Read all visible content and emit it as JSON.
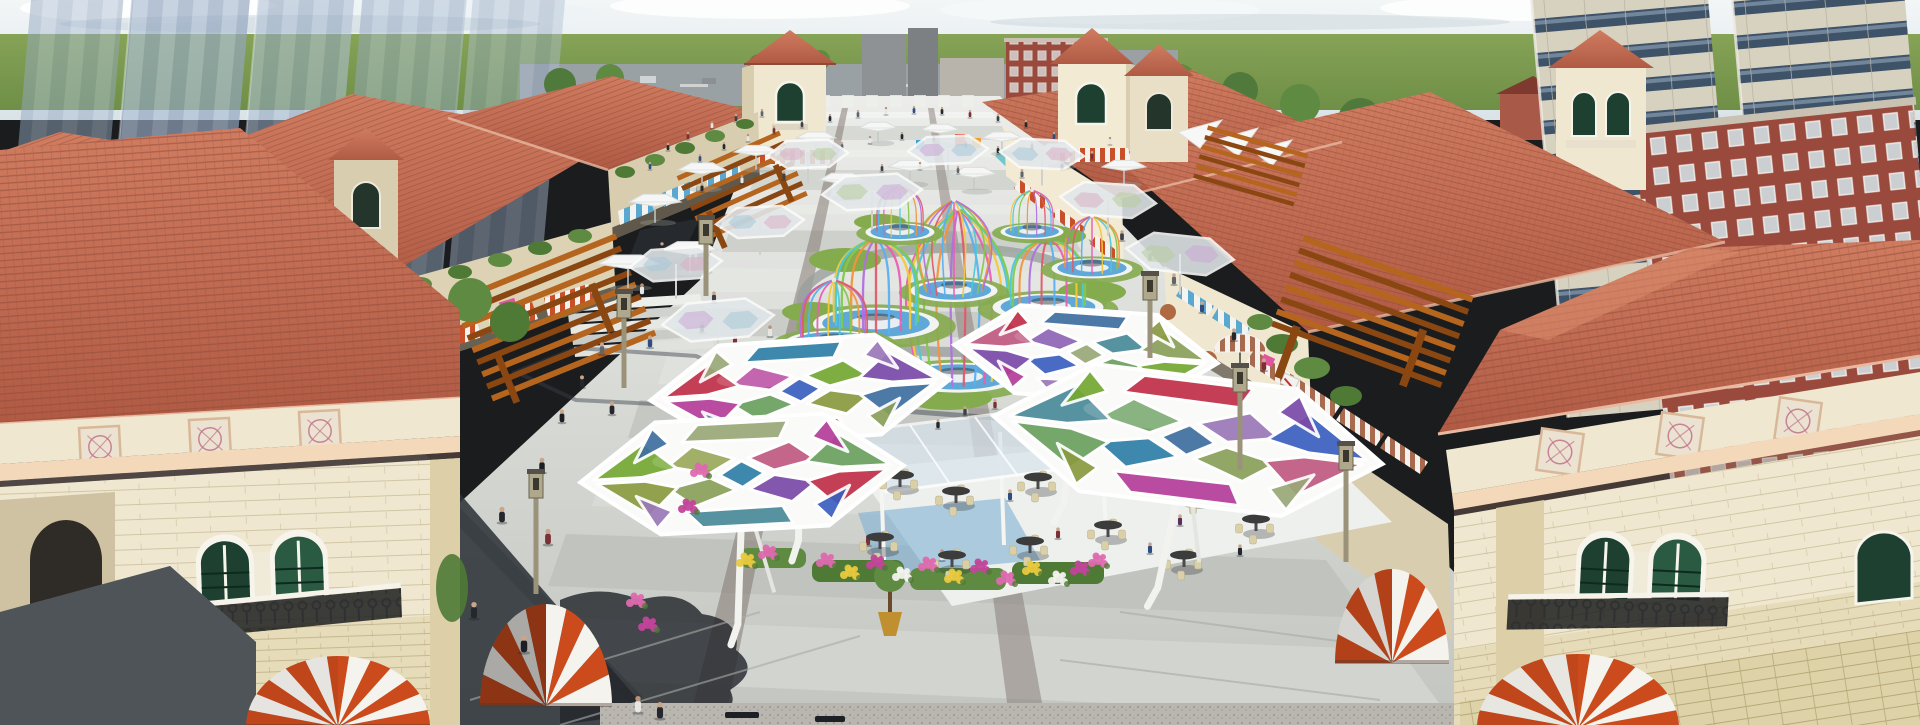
{
  "palette": {
    "sky_top": "#f3f6f7",
    "sky_low": "#d9e3e8",
    "cloud": "#ffffff",
    "cloud_shade": "#c5d2da",
    "field": "#83a153",
    "field_dark": "#5f8140",
    "road": "#9aa1a5",
    "ghost_a": "#aebfd4",
    "ghost_b": "#93a6bf",
    "tower_wall": "#d7d1c0",
    "tower_band": "#3e5268",
    "tower_glass": "#7e94a8",
    "brick": "#9a4a3c",
    "brick_light": "#b06a58",
    "roof": "#c2674f",
    "roof_dark": "#8e4a38",
    "roof_light": "#d98a6a",
    "ridge": "#e8b9a0",
    "wall": "#efe7d0",
    "wall_shade": "#d9cdb0",
    "wall_dark": "#c9bd9e",
    "sand": "#e6dcba",
    "sand_line": "#c6b88e",
    "cornice": "#f3d9ba",
    "medallion_bg": "#ece2d2",
    "medallion_ink": "#c2798c",
    "win_green": "#1d4030",
    "win_green2": "#2a5a42",
    "frame": "#f7f4ec",
    "iron": "#2e2f31",
    "awn_orange": "#cb4b1d",
    "awn_white": "#f5f3ee",
    "awn_blue": "#5aa7cf",
    "awn_brown": "#a76a4e",
    "sign_pink": "#e0559e",
    "pergola": "#b5651d",
    "pergola_dark": "#8a4712",
    "pave_base": "#d9dbd7",
    "pave_light": "#eceeea",
    "pave_mid": "#cfd2cd",
    "pave_dark": "#a8aba6",
    "strip_brown": "#7d6f6a",
    "shadow": "#2e3339",
    "shadow_soft": "#454b54",
    "grass": "#85ab4f",
    "bush": "#4f7a36",
    "tree": "#5e8a42",
    "water": "#5fa8d8",
    "water_deep": "#3d7fb5",
    "base_white": "#f2f4f4",
    "glass": "#d7e4ec",
    "deck": "#eef0ee",
    "carpet": "#7fb0d4",
    "table_dark": "#3c3c3c",
    "chair_tan": "#d9cfa8",
    "pot_gold": "#c08f2f",
    "pot_clay": "#b06a42",
    "granite": "#b9b6b0",
    "lamp": "#9a937a",
    "lamp_head": "#b0a88c",
    "flower_pink": "#dd6aae",
    "flower_magenta": "#c2449a",
    "flower_yellow": "#e9c93e",
    "flower_white": "#f2f2ee",
    "flower_red": "#c04545"
  },
  "people_colors": [
    "#24272c",
    "#3c4148",
    "#60666e",
    "#7a3034",
    "#2f4d7e",
    "#e6e6e4",
    "#8a6a52",
    "#1c1f23",
    "#9a9ea6",
    "#5a2f5a"
  ],
  "cage_colors": [
    "#e85fb0",
    "#f2c83c",
    "#4cc8d8",
    "#82c84e",
    "#f2923c",
    "#b070e0",
    "#e05a6a",
    "#58b0f0"
  ],
  "hex_panel_colors": [
    "#c03048",
    "#b43d9a",
    "#3b5fc0",
    "#74a832",
    "#8a9a40",
    "#2f7fa8",
    "#c05a80",
    "#7a4aa8",
    "#9aa878",
    "#4a8a9a",
    "#6aa060",
    "#3f6fa0",
    "#9a78b8",
    "#8aa05a"
  ],
  "ghost_tints": [
    "#c9a8d6",
    "#a8c8d8",
    "#d8b0c4",
    "#b8cc9e"
  ],
  "hex_panels": [
    {
      "p": [
        [
          -0.14,
          0
        ],
        [
          0,
          -0.24
        ],
        [
          0.14,
          0
        ],
        [
          0,
          0.24
        ]
      ],
      "ci": 2
    },
    {
      "p": [
        [
          0.04,
          -0.28
        ],
        [
          0.3,
          -0.54
        ],
        [
          0.46,
          -0.2
        ],
        [
          0.2,
          -0.04
        ]
      ],
      "ci": 3
    },
    {
      "p": [
        [
          0.2,
          0.04
        ],
        [
          0.46,
          0.2
        ],
        [
          0.3,
          0.54
        ],
        [
          0.04,
          0.28
        ]
      ],
      "ci": 4
    },
    {
      "p": [
        [
          -0.04,
          0.28
        ],
        [
          -0.3,
          0.54
        ],
        [
          -0.46,
          0.2
        ],
        [
          -0.2,
          0.04
        ]
      ],
      "ci": 10
    },
    {
      "p": [
        [
          -0.2,
          -0.04
        ],
        [
          -0.46,
          -0.2
        ],
        [
          -0.3,
          -0.54
        ],
        [
          -0.04,
          -0.28
        ]
      ],
      "ci": 1
    },
    {
      "p": [
        [
          -0.92,
          -0.03
        ],
        [
          -0.6,
          -0.64
        ],
        [
          -0.4,
          -0.16
        ],
        [
          -0.62,
          -0.03
        ]
      ],
      "ci": 0
    },
    {
      "p": [
        [
          -0.9,
          0.04
        ],
        [
          -0.6,
          0.04
        ],
        [
          -0.4,
          0.18
        ],
        [
          -0.58,
          0.66
        ]
      ],
      "ci": 1
    },
    {
      "p": [
        [
          0.92,
          -0.03
        ],
        [
          0.6,
          -0.64
        ],
        [
          0.4,
          -0.16
        ],
        [
          0.62,
          -0.03
        ]
      ],
      "ci": 7
    },
    {
      "p": [
        [
          0.9,
          0.04
        ],
        [
          0.6,
          0.04
        ],
        [
          0.4,
          0.18
        ],
        [
          0.58,
          0.66
        ]
      ],
      "ci": 11
    },
    {
      "p": [
        [
          -0.36,
          -0.62
        ],
        [
          -0.26,
          -0.92
        ],
        [
          0.3,
          -0.92
        ],
        [
          0.24,
          -0.6
        ]
      ],
      "ci": 5
    },
    {
      "p": [
        [
          -0.36,
          0.62
        ],
        [
          -0.26,
          0.92
        ],
        [
          0.3,
          0.92
        ],
        [
          0.24,
          0.6
        ]
      ],
      "ci": 6
    },
    {
      "p": [
        [
          -0.54,
          -0.9
        ],
        [
          -0.44,
          -0.6
        ],
        [
          -0.66,
          -0.3
        ]
      ],
      "ci": 8
    },
    {
      "p": [
        [
          0.54,
          -0.9
        ],
        [
          0.44,
          -0.6
        ],
        [
          0.66,
          -0.3
        ]
      ],
      "ci": 12
    },
    {
      "p": [
        [
          -0.54,
          0.9
        ],
        [
          -0.44,
          0.6
        ],
        [
          -0.66,
          0.3
        ]
      ],
      "ci": 9
    },
    {
      "p": [
        [
          0.54,
          0.9
        ],
        [
          0.44,
          0.6
        ],
        [
          0.66,
          0.3
        ]
      ],
      "ci": 13
    }
  ],
  "scene": {
    "canopies": [
      {
        "x": 800,
        "y": 390,
        "sx": 150,
        "sy": 50,
        "rot": -4,
        "shift": 0
      },
      {
        "x": 742,
        "y": 474,
        "sx": 162,
        "sy": 56,
        "rot": -3,
        "shift": 3
      },
      {
        "x": 1086,
        "y": 354,
        "sx": 132,
        "sy": 44,
        "rot": 4,
        "shift": 6
      },
      {
        "x": 1188,
        "y": 440,
        "sx": 196,
        "sy": 64,
        "rot": 7,
        "shift": 9
      }
    ],
    "ghost_hexes": [
      [
        718,
        320,
        56,
        -5,
        0
      ],
      [
        676,
        264,
        46,
        -4,
        1
      ],
      [
        808,
        154,
        40,
        -2,
        2
      ],
      [
        872,
        192,
        50,
        -3,
        3
      ],
      [
        948,
        150,
        40,
        -2,
        0
      ],
      [
        1042,
        154,
        42,
        3,
        1
      ],
      [
        1108,
        200,
        48,
        4,
        2
      ],
      [
        1180,
        254,
        54,
        6,
        3
      ],
      [
        760,
        222,
        44,
        -3,
        1
      ]
    ],
    "white_umbrellas": [
      [
        655,
        202,
        26
      ],
      [
        702,
        170,
        24
      ],
      [
        756,
        152,
        22
      ],
      [
        816,
        138,
        20
      ],
      [
        878,
        128,
        19
      ],
      [
        940,
        130,
        19
      ],
      [
        1002,
        138,
        20
      ],
      [
        1058,
        150,
        21
      ],
      [
        842,
        180,
        23
      ],
      [
        910,
        167,
        22
      ],
      [
        974,
        174,
        22
      ],
      [
        628,
        264,
        30
      ],
      [
        1124,
        167,
        22
      ],
      [
        690,
        250,
        28
      ]
    ],
    "cages": [
      {
        "x": 958,
        "b": 374,
        "t": 208,
        "rx": 40,
        "ry": 12,
        "type": "vase",
        "n": 12,
        "shift": 0
      },
      {
        "x": 954,
        "b": 288,
        "t": 200,
        "rx": 29,
        "ry": 9,
        "type": "vase",
        "n": 11,
        "shift": 3
      },
      {
        "x": 876,
        "b": 320,
        "h": 82,
        "rx": 42,
        "ry": 13,
        "type": "dome",
        "n": 11,
        "shift": 1
      },
      {
        "x": 834,
        "b": 340,
        "h": 60,
        "rx": 33,
        "ry": 10,
        "type": "dome",
        "n": 10,
        "shift": 5
      },
      {
        "x": 1048,
        "b": 304,
        "h": 66,
        "rx": 37,
        "ry": 11,
        "type": "dome",
        "n": 10,
        "shift": 2
      },
      {
        "x": 1092,
        "b": 266,
        "h": 50,
        "rx": 27,
        "ry": 8,
        "type": "dome",
        "n": 9,
        "shift": 4
      },
      {
        "x": 900,
        "b": 230,
        "h": 44,
        "rx": 23,
        "ry": 7,
        "type": "dome",
        "n": 9,
        "shift": 6
      },
      {
        "x": 1032,
        "b": 230,
        "h": 40,
        "rx": 21,
        "ry": 6,
        "type": "dome",
        "n": 8,
        "shift": 1
      }
    ],
    "domes": [
      {
        "cont": "g-dome-left",
        "cx": 338,
        "cy": 727,
        "rx": 92,
        "ry": 71,
        "n": 13,
        "shade": 0.06
      },
      {
        "cont": "g-dome-right",
        "cx": 1578,
        "cy": 728,
        "rx": 101,
        "ry": 74,
        "n": 13,
        "shade": 0.05
      },
      {
        "cont": "g-dome-midR",
        "cx": 1392,
        "cy": 663,
        "rx": 57,
        "ry": 94,
        "n": 10,
        "shade": 0.12
      },
      {
        "cont": "g-dome-midL",
        "cx": 546,
        "cy": 706,
        "rx": 66,
        "ry": 102,
        "n": 10,
        "shade": 0.3
      }
    ],
    "medallions": [
      {
        "cont": "g-med-left",
        "s": 40,
        "rot": -3,
        "pts": [
          [
            100,
            447
          ],
          [
            210,
            439
          ],
          [
            320,
            431
          ]
        ]
      },
      {
        "cont": "g-med-right",
        "s": 42,
        "rot": 8,
        "pts": [
          [
            1560,
            452
          ],
          [
            1680,
            436
          ],
          [
            1798,
            421
          ]
        ]
      }
    ],
    "lamps": [
      [
        536,
        498,
        96
      ],
      [
        624,
        318,
        70
      ],
      [
        706,
        244,
        52
      ],
      [
        1240,
        392,
        78
      ],
      [
        1150,
        300,
        58
      ],
      [
        1346,
        470,
        92
      ]
    ],
    "tables": [
      [
        880,
        548
      ],
      [
        952,
        566
      ],
      [
        1030,
        552
      ],
      [
        1108,
        536
      ],
      [
        956,
        502
      ],
      [
        1038,
        488
      ],
      [
        1118,
        472
      ],
      [
        1196,
        500
      ],
      [
        1256,
        530
      ],
      [
        1184,
        566
      ],
      [
        900,
        486
      ],
      [
        1270,
        464
      ]
    ],
    "flowers": [
      [
        826,
        560,
        "p"
      ],
      [
        850,
        572,
        "y"
      ],
      [
        876,
        562,
        "m"
      ],
      [
        902,
        574,
        "w"
      ],
      [
        928,
        564,
        "p"
      ],
      [
        954,
        576,
        "y"
      ],
      [
        980,
        566,
        "m"
      ],
      [
        1006,
        578,
        "p"
      ],
      [
        1032,
        568,
        "y"
      ],
      [
        1058,
        578,
        "w"
      ],
      [
        1080,
        568,
        "m"
      ],
      [
        768,
        552,
        "p"
      ],
      [
        746,
        560,
        "y"
      ],
      [
        700,
        470,
        "p"
      ],
      [
        688,
        506,
        "m"
      ],
      [
        1098,
        560,
        "p"
      ],
      [
        648,
        624,
        "m"
      ],
      [
        636,
        600,
        "p"
      ]
    ],
    "benches": [
      [
        742,
        716
      ],
      [
        832,
        720
      ]
    ],
    "people": [
      [
        668,
        150,
        8,
        0
      ],
      [
        688,
        139,
        8,
        3
      ],
      [
        712,
        128,
        8,
        5
      ],
      [
        736,
        121,
        8,
        1
      ],
      [
        762,
        116,
        8,
        2
      ],
      [
        700,
        161,
        8,
        4
      ],
      [
        724,
        149,
        8,
        0
      ],
      [
        748,
        141,
        8,
        5
      ],
      [
        774,
        133,
        8,
        3
      ],
      [
        802,
        127,
        8,
        1
      ],
      [
        830,
        121,
        8,
        0
      ],
      [
        858,
        117,
        8,
        2
      ],
      [
        886,
        114,
        8,
        5
      ],
      [
        914,
        113,
        8,
        4
      ],
      [
        942,
        114,
        8,
        0
      ],
      [
        970,
        117,
        8,
        3
      ],
      [
        998,
        121,
        8,
        1
      ],
      [
        1026,
        127,
        8,
        0
      ],
      [
        842,
        149,
        8,
        2
      ],
      [
        870,
        143,
        8,
        5
      ],
      [
        902,
        139,
        8,
        0
      ],
      [
        934,
        141,
        8,
        4
      ],
      [
        966,
        147,
        8,
        3
      ],
      [
        998,
        153,
        8,
        0
      ],
      [
        882,
        171,
        8,
        1
      ],
      [
        920,
        169,
        8,
        5
      ],
      [
        958,
        173,
        8,
        2
      ],
      [
        808,
        159,
        8,
        0
      ],
      [
        1032,
        149,
        8,
        3
      ],
      [
        1054,
        139,
        8,
        4
      ],
      [
        702,
        191,
        9,
        0
      ],
      [
        742,
        183,
        9,
        5
      ],
      [
        784,
        179,
        9,
        1
      ],
      [
        1022,
        177,
        9,
        2
      ],
      [
        1062,
        169,
        9,
        0
      ],
      [
        1092,
        159,
        9,
        3
      ],
      [
        650,
        169,
        8,
        4
      ],
      [
        1110,
        144,
        8,
        5
      ],
      [
        662,
        252,
        11,
        0
      ],
      [
        696,
        264,
        11,
        3
      ],
      [
        642,
        294,
        12,
        5
      ],
      [
        714,
        302,
        12,
        1
      ],
      [
        627,
        320,
        12,
        0
      ],
      [
        602,
        354,
        13,
        2
      ],
      [
        650,
        347,
        13,
        4
      ],
      [
        702,
        332,
        12,
        0
      ],
      [
        582,
        387,
        13,
        0
      ],
      [
        562,
        422,
        14,
        7
      ],
      [
        612,
        414,
        14,
        0
      ],
      [
        735,
        345,
        12,
        3
      ],
      [
        770,
        336,
        12,
        5
      ],
      [
        745,
        388,
        13,
        1
      ],
      [
        700,
        392,
        13,
        0
      ],
      [
        682,
        432,
        14,
        2
      ],
      [
        764,
        432,
        14,
        4
      ],
      [
        692,
        472,
        15,
        0
      ],
      [
        904,
        397,
        12,
        3
      ],
      [
        940,
        392,
        12,
        5
      ],
      [
        1122,
        240,
        11,
        1
      ],
      [
        1150,
        260,
        11,
        0
      ],
      [
        1174,
        284,
        12,
        2
      ],
      [
        1202,
        312,
        12,
        4
      ],
      [
        1234,
        340,
        13,
        0
      ],
      [
        1264,
        370,
        13,
        3
      ],
      [
        1288,
        400,
        13,
        5
      ],
      [
        1158,
        324,
        12,
        1
      ],
      [
        1192,
        354,
        12,
        0
      ],
      [
        1176,
        342,
        12,
        2
      ],
      [
        542,
        472,
        16,
        7
      ],
      [
        502,
        522,
        17,
        0
      ],
      [
        548,
        544,
        17,
        3
      ],
      [
        432,
        562,
        17,
        7
      ],
      [
        384,
        544,
        17,
        0
      ],
      [
        354,
        602,
        18,
        7
      ],
      [
        474,
        618,
        18,
        0
      ],
      [
        524,
        652,
        19,
        7
      ],
      [
        638,
        712,
        18,
        5
      ],
      [
        660,
        718,
        18,
        0
      ],
      [
        402,
        436,
        15,
        7
      ],
      [
        352,
        566,
        17,
        0
      ],
      [
        868,
        545,
        12,
        3
      ],
      [
        1010,
        500,
        12,
        4
      ],
      [
        1098,
        470,
        11,
        1
      ],
      [
        1180,
        525,
        12,
        9
      ],
      [
        1240,
        555,
        12,
        0
      ],
      [
        942,
        560,
        12,
        5
      ],
      [
        1058,
        538,
        12,
        3
      ],
      [
        1150,
        553,
        12,
        4
      ],
      [
        965,
        415,
        10,
        1
      ],
      [
        995,
        408,
        10,
        3
      ],
      [
        1028,
        420,
        10,
        9
      ],
      [
        938,
        428,
        10,
        0
      ]
    ]
  }
}
